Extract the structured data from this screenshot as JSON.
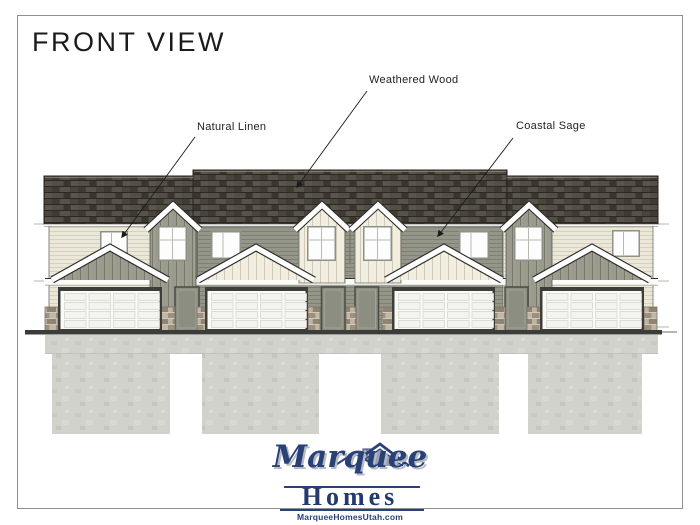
{
  "page": {
    "title": "FRONT VIEW"
  },
  "callouts": {
    "natural_linen": {
      "label": "Natural Linen",
      "points_to": "cream horizontal siding, end unit wall"
    },
    "weathered_wood": {
      "label": "Weathered Wood",
      "points_to": "shingle roof"
    },
    "coastal_sage": {
      "label": "Coastal Sage",
      "points_to": "sage horizontal siding, center units wall"
    }
  },
  "logo": {
    "name": "Marquee",
    "word": "Homes",
    "website": "MarqueeHomesUtah.com"
  },
  "colors": {
    "roof_weathered_wood": "#46413a",
    "siding_natural_linen": "#ebe7d9",
    "siding_coastal_sage": "#95968a",
    "trim_white": "#fbfbf8",
    "entry_door_gray": "#8b8e80",
    "stone_tan": "#b5a997",
    "foundation_gray": "#d2d2cd",
    "logo_navy": "#2a4177"
  }
}
